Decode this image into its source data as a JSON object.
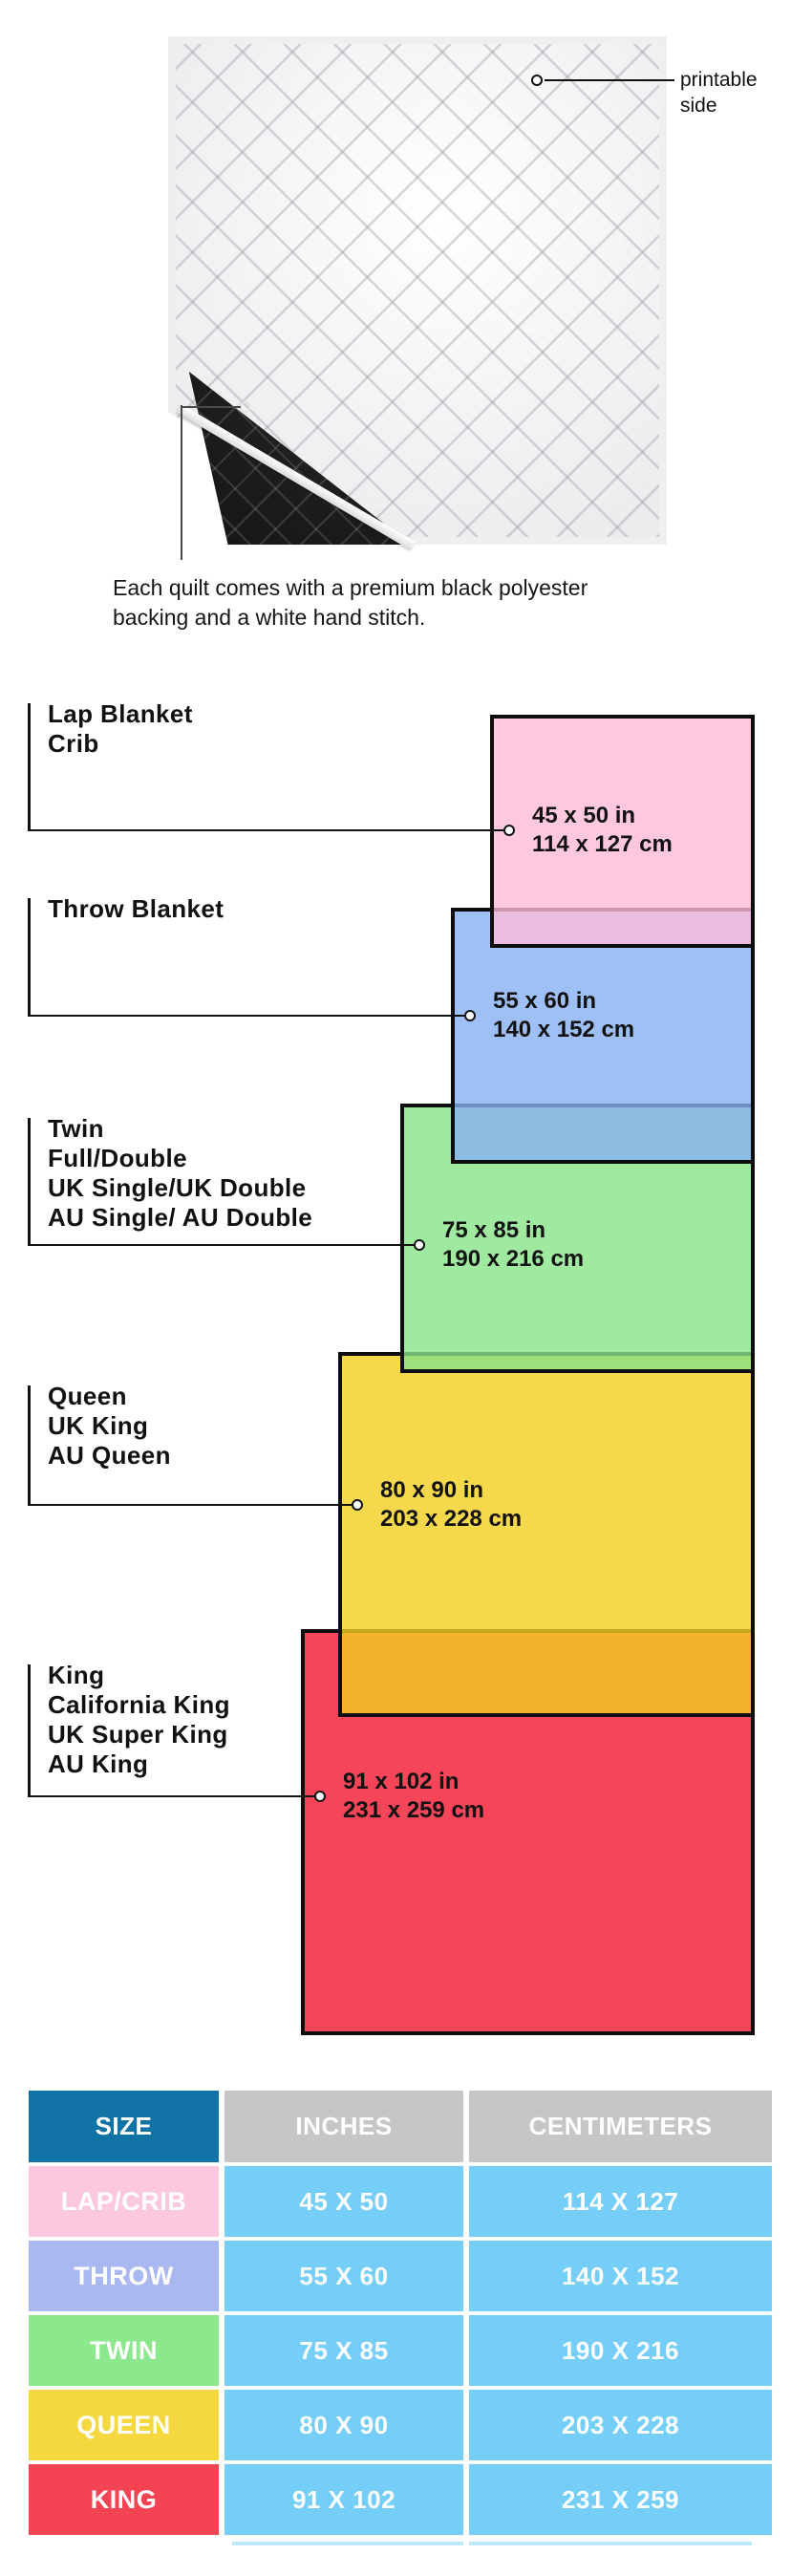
{
  "product_note": {
    "printable_side_label": "printable side",
    "caption_lines": [
      "Each quilt comes with a premium black polyester",
      "backing and a white hand stitch."
    ]
  },
  "diagram": {
    "sections": [
      {
        "id": "lap-crib",
        "labels": [
          "Lap Blanket",
          "Crib"
        ],
        "inches": "45 x 50 in",
        "cm": "114 x 127 cm",
        "color": "#FFC8E0"
      },
      {
        "id": "throw",
        "labels": [
          "Throw Blanket"
        ],
        "inches": "55 x 60 in",
        "cm": "140 x 152 cm",
        "color": "#9FC0F5"
      },
      {
        "id": "twin",
        "labels": [
          "Twin",
          "Full/Double",
          "UK Single/UK Double",
          "AU Single/ AU Double"
        ],
        "inches": "75 x 85 in",
        "cm": "190 x 216 cm",
        "color": "#A4E8A4"
      },
      {
        "id": "queen",
        "labels": [
          "Queen",
          "UK King",
          "AU Queen"
        ],
        "inches": "80 x 90 in",
        "cm": "203 x 228 cm",
        "color": "#F5D84A"
      },
      {
        "id": "king",
        "labels": [
          "King",
          "California King",
          "UK Super King",
          "AU King"
        ],
        "inches": "91 x 102 in",
        "cm": "231 x 259 cm",
        "color": "#F4475A"
      }
    ]
  },
  "table": {
    "headers": {
      "size": "SIZE",
      "inches": "INCHES",
      "centimeters": "CENTIMETERS"
    },
    "colors": {
      "size_header_bg": "#1173A5",
      "header_bg": "#C6C6C6",
      "value_bg": "#74CEF7"
    },
    "rows": [
      {
        "size": "LAP/CRIB",
        "inches": "45 X 50",
        "cm": "114 X 127",
        "label_color": "#FBC8DF"
      },
      {
        "size": "THROW",
        "inches": "55 X 60",
        "cm": "140 X 152",
        "label_color": "#AAB8F2"
      },
      {
        "size": "TWIN",
        "inches": "75 X 85",
        "cm": "190 X 216",
        "label_color": "#8DE88D"
      },
      {
        "size": "QUEEN",
        "inches": "80 X 90",
        "cm": "203 X 228",
        "label_color": "#F5D83F"
      },
      {
        "size": "KING",
        "inches": "91 X 102",
        "cm": "231 X 259",
        "label_color": "#F44453"
      }
    ]
  }
}
